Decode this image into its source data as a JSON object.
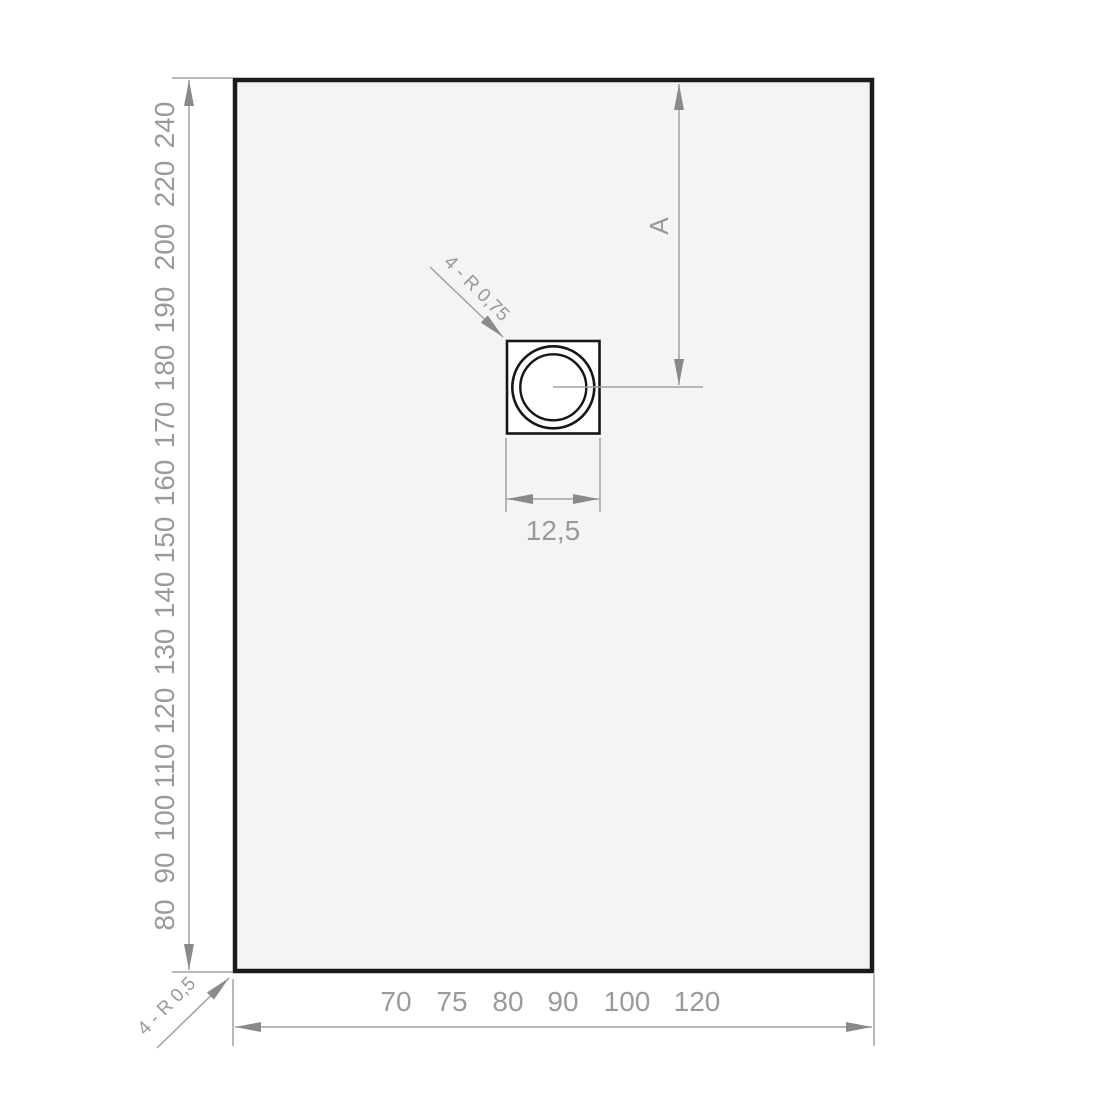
{
  "colors": {
    "outline": "#1b1b1b",
    "tray_fill": "#f4f4f4",
    "line": "#a0a0a0",
    "arrow": "#8a8a8a",
    "text": "#9a9a9a"
  },
  "drawing": {
    "length_labels": [
      "240",
      "220",
      "200",
      "190",
      "180",
      "170",
      "160",
      "150",
      "140",
      "130",
      "120",
      "110",
      "100",
      "90",
      "80"
    ],
    "width_labels": [
      "70",
      "75",
      "80",
      "90",
      "100",
      "120"
    ],
    "drain": {
      "width_label": "12,5",
      "corner_radius_label": "4 - R 0,75",
      "center_distance_label": "A"
    },
    "tray": {
      "corner_radius_label": "4 - R 0,5"
    }
  }
}
